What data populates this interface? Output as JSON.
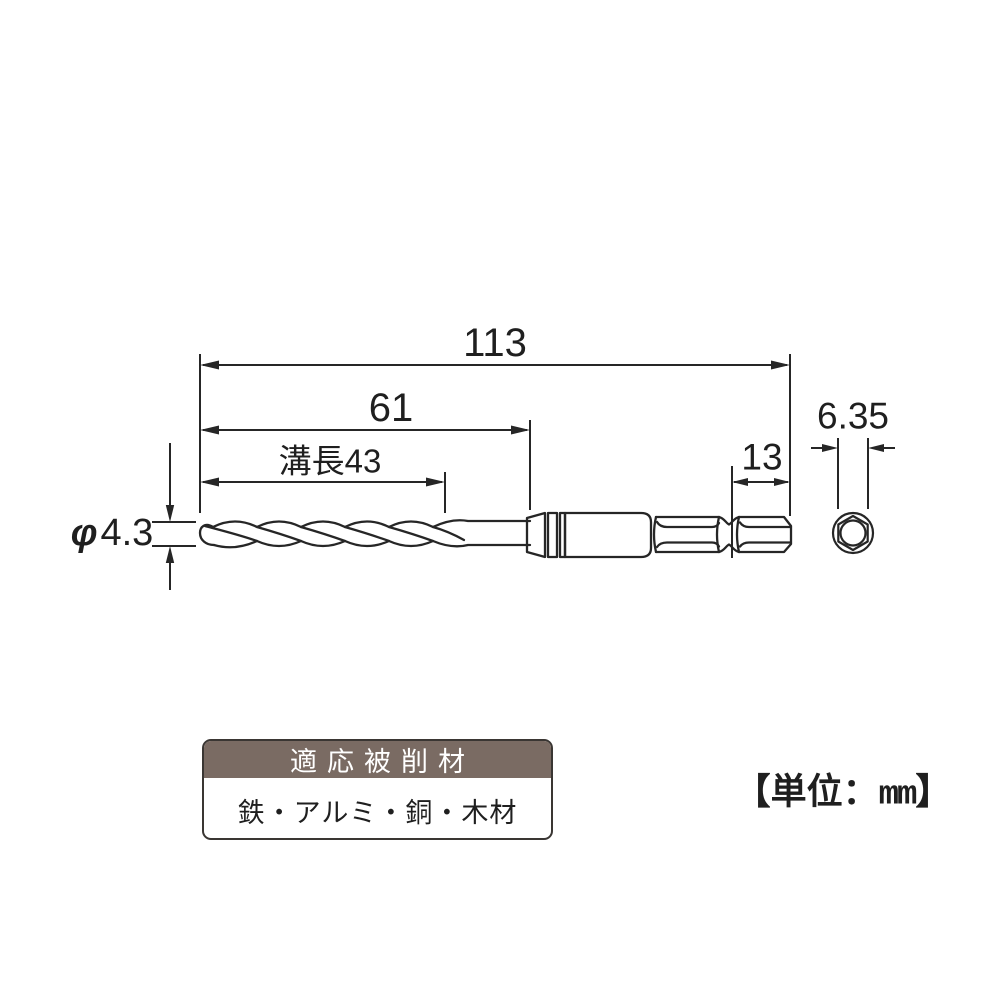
{
  "diagram": {
    "title_hint": "drill bit dimensional drawing",
    "dimensions": {
      "overall_length": "113",
      "tip_to_sleeve_length": "61",
      "flute_length": "溝長43",
      "hex_end_length": "13",
      "hex_shank_width": "6.35",
      "diameter_symbol": "φ",
      "diameter_value": "4.3"
    },
    "unit_note": {
      "prefix": "【単位：",
      "unit": "mm",
      "suffix": "】"
    }
  },
  "materials_table": {
    "header": "適応被削材",
    "body": "鉄・アルミ・銅・木材"
  },
  "colors": {
    "line": "#262626",
    "table_header_bg": "#7a6b63",
    "table_border": "#3a3633",
    "background": "#ffffff"
  }
}
